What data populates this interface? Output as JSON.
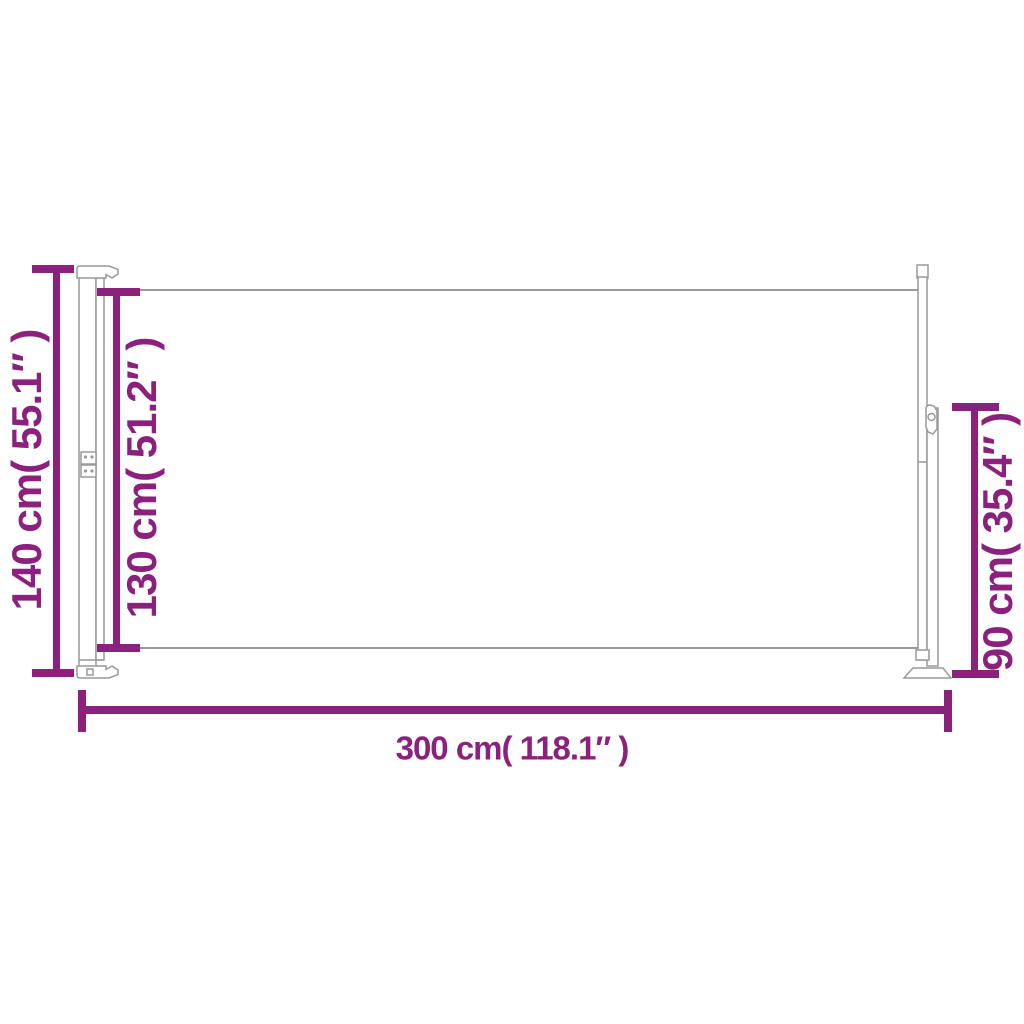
{
  "diagram": {
    "type": "product-dimension-diagram",
    "subject": "retractable side awning, extended, side profile view",
    "colors": {
      "dimension_accent": "#8B217D",
      "outline": "#999999",
      "background": "#FFFFFF"
    },
    "dimensions": {
      "total_height": {
        "label": "140 cm( 55.1″ )",
        "value_cm": 140,
        "value_inch": 55.1
      },
      "fabric_height": {
        "label": "130 cm( 51.2″ )",
        "value_cm": 130,
        "value_inch": 51.2
      },
      "right_height": {
        "label": "90 cm( 35.4″ )",
        "value_cm": 90,
        "value_inch": 35.4
      },
      "total_width": {
        "label": "300 cm( 118.1″ )",
        "value_cm": 300,
        "value_inch": 118.1
      }
    }
  }
}
